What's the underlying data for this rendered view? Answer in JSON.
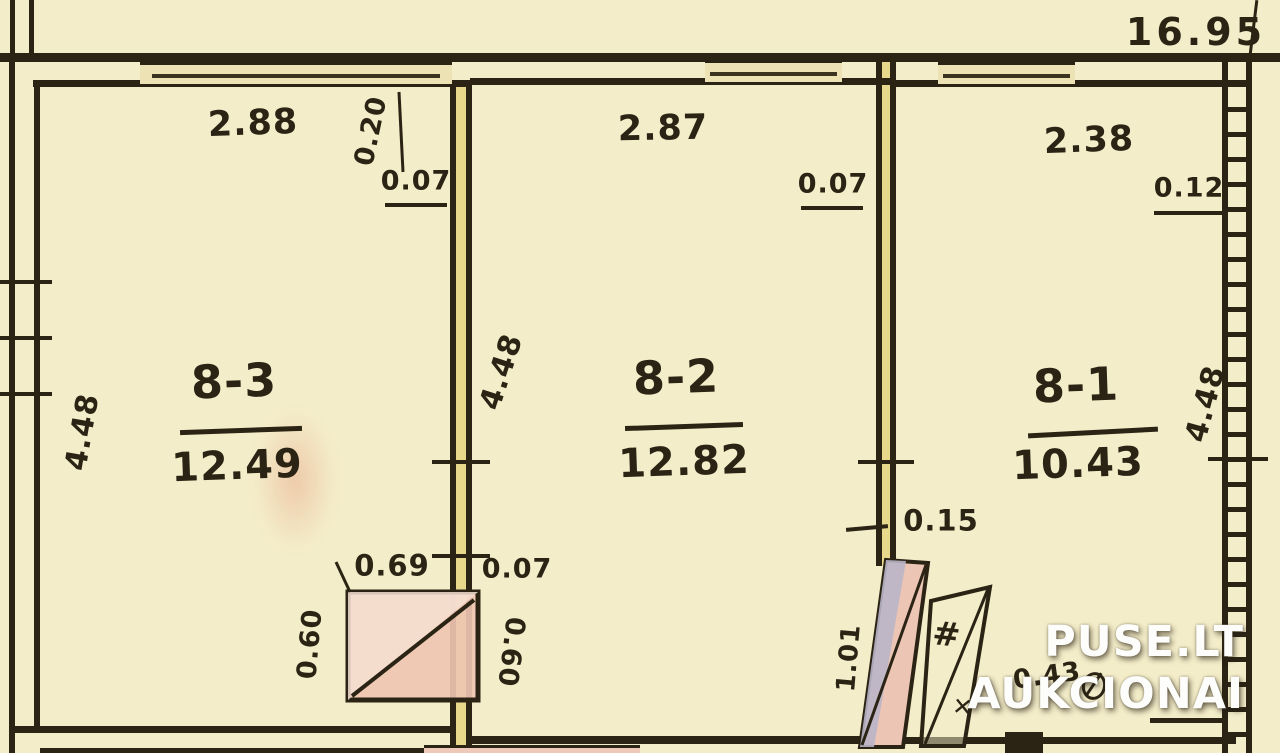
{
  "overall": {
    "total_length": "16.95"
  },
  "rooms": [
    {
      "number": "8-3",
      "area": "12.49",
      "width": "2.88",
      "height": "4.48"
    },
    {
      "number": "8-2",
      "area": "12.82",
      "width": "2.87",
      "height": "4.48"
    },
    {
      "number": "8-1",
      "area": "10.43",
      "width": "2.38",
      "height": "4.48"
    }
  ],
  "dimensions": {
    "duct_width": "0.20",
    "partition_left": "0.07",
    "partition_mid": "0.07",
    "partition_right": "0.12",
    "stove_width": "0.69",
    "stove_partition": "0.07",
    "stove_depth_left": "0.60",
    "stove_depth_right": "0.60",
    "ledge": "0.15",
    "stove_side": "1.01",
    "small_dim": "0.43"
  },
  "symbols": {
    "hash": "#",
    "cross": "✕"
  },
  "watermark": {
    "line1": "PUSE.LT",
    "line2": "AUKCIONAI"
  },
  "colors": {
    "paper": "#f4edc9",
    "wall_fill": "#e8d88b",
    "ink": "#2b2415",
    "stove_pink": "#eec5b2",
    "stove_grey": "#b9b5c7",
    "watermark": "#ffffff"
  }
}
